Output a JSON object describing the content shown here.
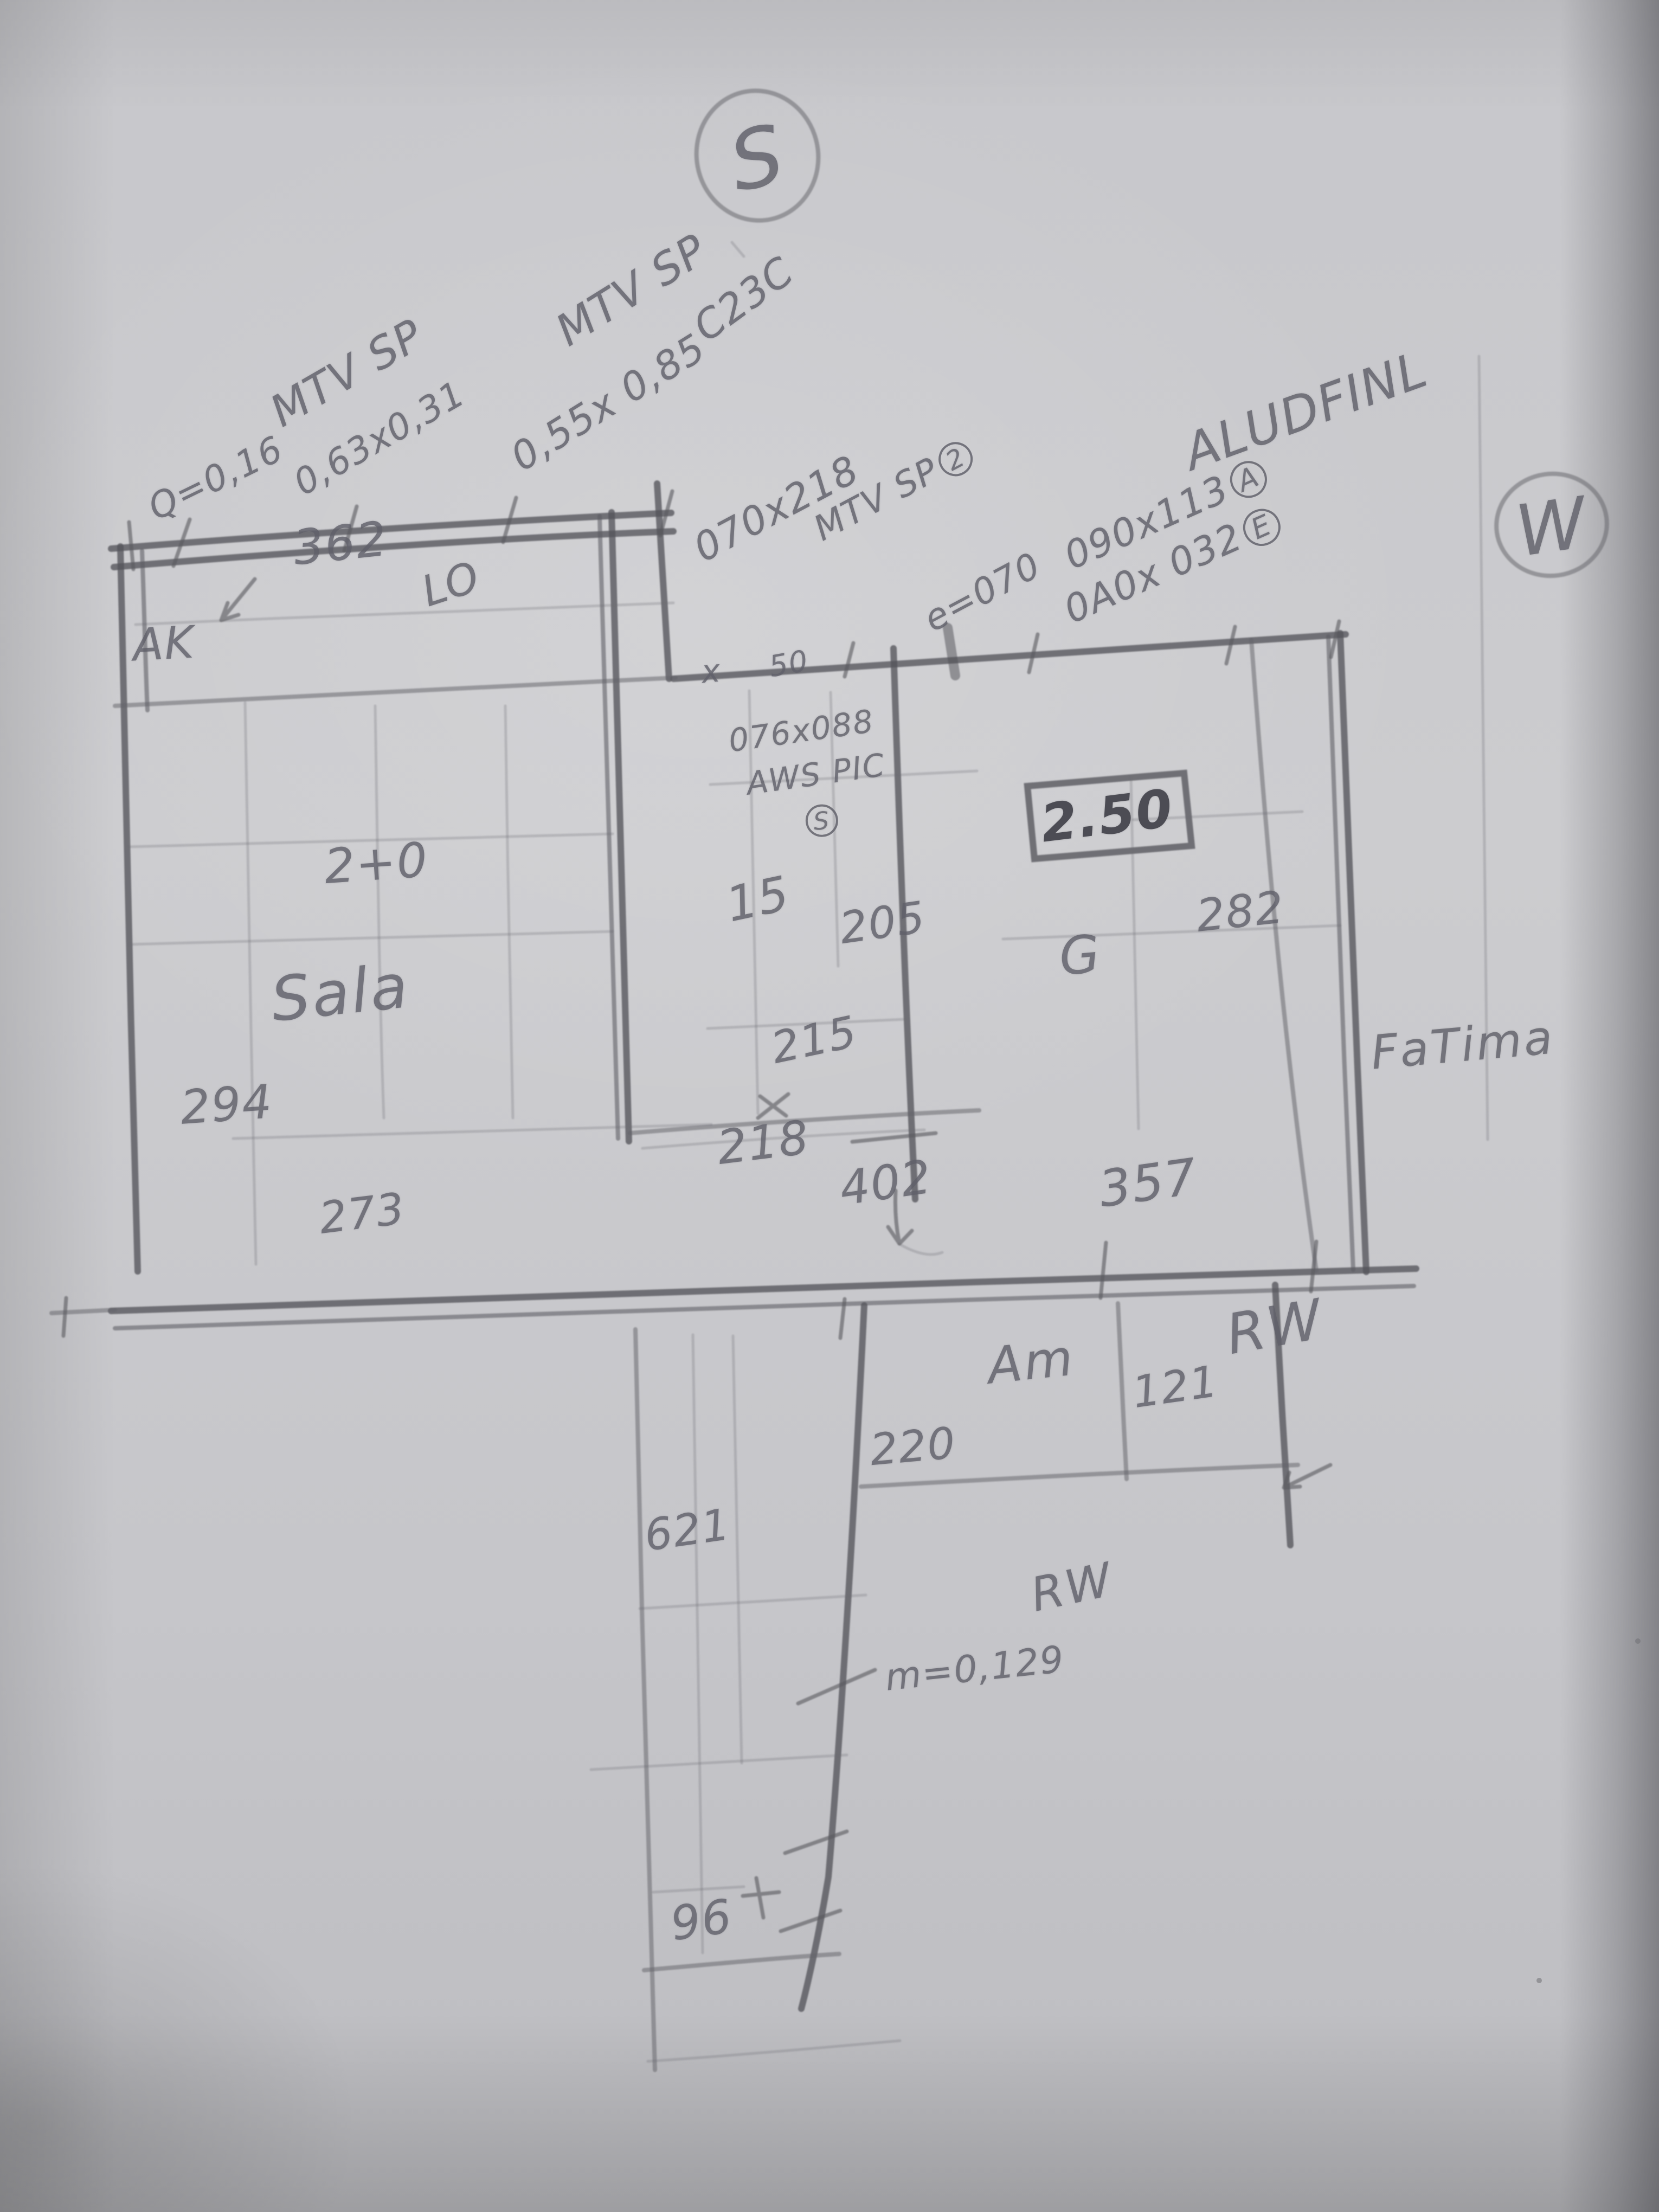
{
  "compass": {
    "south": "S",
    "west": "W"
  },
  "notes": {
    "win1": {
      "l1": "MTV SP",
      "l2": "0,63x0,31",
      "l3": "Q=0,16"
    },
    "win2": {
      "l1": "MTV SP",
      "l2": "0,55x 0,85",
      "l3": "C23C"
    },
    "door": {
      "l1": "070x218",
      "l2": "MTV SP",
      "l2_circle": "2"
    },
    "eave": "e=070",
    "win3": {
      "l1": "090x113",
      "l1_circle": "A",
      "l2": "0A0x 032",
      "l2_circle": "E"
    },
    "alud": "ALUDFINL",
    "aws": {
      "l1": "076x088",
      "l2": "AWS PIC",
      "circle": "S"
    },
    "boxed_height": "2.50",
    "g_mark": "G",
    "lo_mark": "LO",
    "ak": "AK",
    "x_mark": "x",
    "mark_50": "50",
    "sill_note": "m=0,129"
  },
  "rooms": {
    "sala": "Sala",
    "fatima": "FaTima",
    "am": "Am",
    "rw_upper": "RW",
    "rw_lower": "RW"
  },
  "dims": {
    "top": "362",
    "w294": "294",
    "w273": "273",
    "h240": "2+0",
    "c15": "15",
    "c205": "205",
    "c215": "215",
    "c218": "218",
    "c402": "402",
    "r282": "282",
    "r357": "357",
    "am121": "121",
    "am220": "220",
    "cor621": "621",
    "cor96": "96"
  }
}
